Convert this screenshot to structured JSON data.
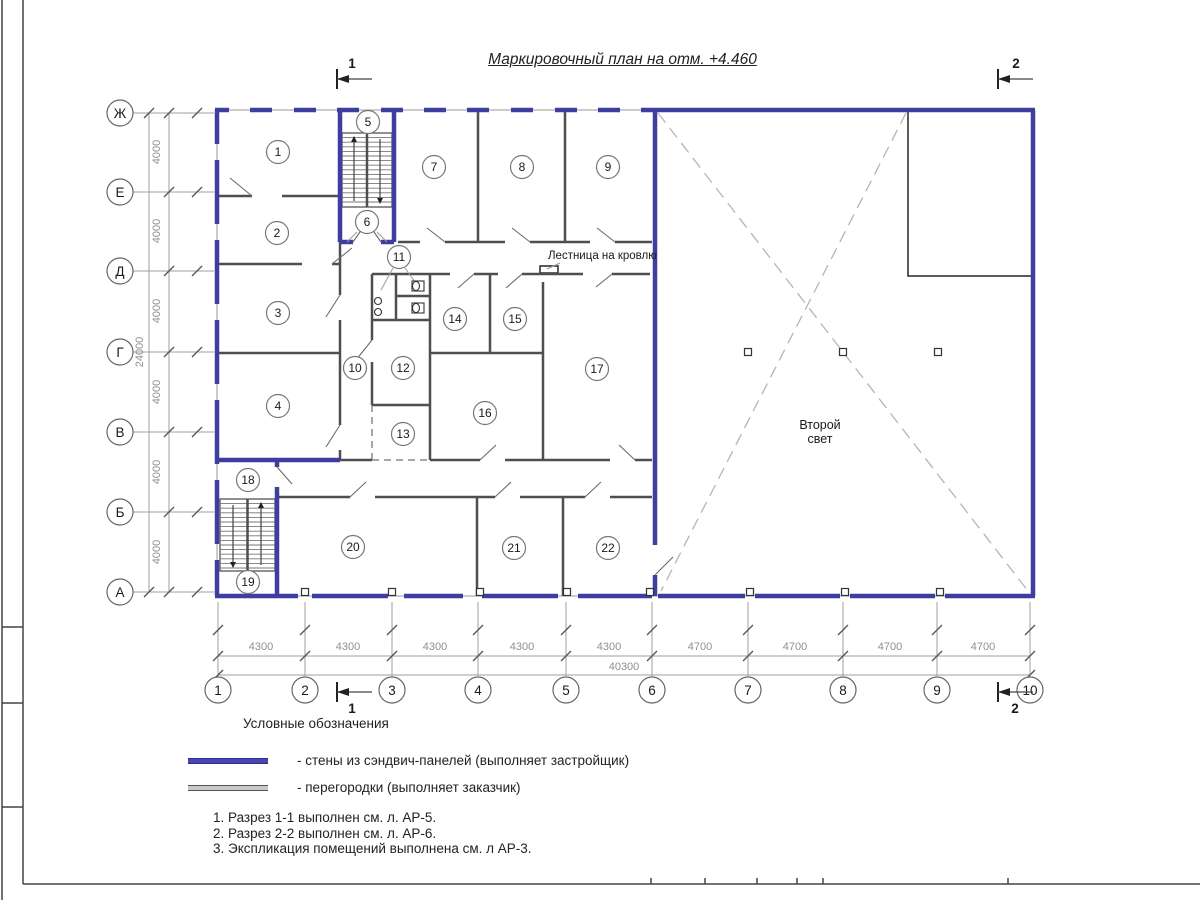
{
  "title": "Маркировочный план на отм. +4.460",
  "legend": {
    "heading": "Условные обозначения",
    "items": [
      {
        "swatch": "blue",
        "color": "#4646b4",
        "label": "- стены из сэндвич-панелей (выполняет застройщик)"
      },
      {
        "swatch": "gray",
        "color": "#c9c9c9",
        "label": "- перегородки (выполняет заказчик)"
      }
    ]
  },
  "notes": [
    "1. Разрез 1-1 выполнен см. л. АР-5.",
    "2. Разрез 2-2 выполнен см. л. АР-6.",
    "3. Экспликация помещений выполнена см. л АР-3."
  ],
  "axes": {
    "rows": [
      {
        "label": "Ж",
        "y": 113
      },
      {
        "label": "Е",
        "y": 192
      },
      {
        "label": "Д",
        "y": 271
      },
      {
        "label": "Г",
        "y": 352
      },
      {
        "label": "В",
        "y": 432
      },
      {
        "label": "Б",
        "y": 512
      },
      {
        "label": "А",
        "y": 592
      }
    ],
    "cols": [
      {
        "label": "1",
        "x": 218
      },
      {
        "label": "2",
        "x": 305
      },
      {
        "label": "3",
        "x": 392
      },
      {
        "label": "4",
        "x": 478
      },
      {
        "label": "5",
        "x": 566
      },
      {
        "label": "6",
        "x": 652
      },
      {
        "label": "7",
        "x": 748
      },
      {
        "label": "8",
        "x": 843
      },
      {
        "label": "9",
        "x": 937
      },
      {
        "label": "10",
        "x": 1030
      }
    ],
    "row_circle_x": 120,
    "col_circle_y": 690,
    "r": 13
  },
  "dims": {
    "lines": [
      [
        169,
        113,
        169,
        592
      ],
      [
        149,
        113,
        149,
        592
      ],
      [
        218,
        656,
        1030,
        656
      ],
      [
        218,
        675,
        1030,
        675
      ]
    ],
    "ext": [
      [
        133,
        113,
        214,
        113
      ],
      [
        133,
        192,
        214,
        192
      ],
      [
        133,
        271,
        214,
        271
      ],
      [
        133,
        352,
        214,
        352
      ],
      [
        133,
        432,
        214,
        432
      ],
      [
        133,
        512,
        214,
        512
      ],
      [
        133,
        592,
        214,
        592
      ],
      [
        218,
        602,
        218,
        676
      ],
      [
        305,
        602,
        305,
        676
      ],
      [
        392,
        602,
        392,
        676
      ],
      [
        478,
        602,
        478,
        676
      ],
      [
        566,
        602,
        566,
        676
      ],
      [
        652,
        602,
        652,
        676
      ],
      [
        748,
        602,
        748,
        676
      ],
      [
        843,
        602,
        843,
        676
      ],
      [
        937,
        602,
        937,
        676
      ],
      [
        1030,
        602,
        1030,
        676
      ]
    ],
    "ticks": [
      [
        169,
        113
      ],
      [
        169,
        192
      ],
      [
        169,
        271
      ],
      [
        169,
        352
      ],
      [
        169,
        432
      ],
      [
        169,
        512
      ],
      [
        169,
        592
      ],
      [
        149,
        113
      ],
      [
        149,
        592
      ],
      [
        197,
        113
      ],
      [
        197,
        192
      ],
      [
        197,
        271
      ],
      [
        197,
        352
      ],
      [
        197,
        432
      ],
      [
        197,
        512
      ],
      [
        197,
        592
      ],
      [
        218,
        630
      ],
      [
        305,
        630
      ],
      [
        392,
        630
      ],
      [
        478,
        630
      ],
      [
        566,
        630
      ],
      [
        652,
        630
      ],
      [
        748,
        630
      ],
      [
        843,
        630
      ],
      [
        937,
        630
      ],
      [
        1030,
        630
      ],
      [
        218,
        656
      ],
      [
        305,
        656
      ],
      [
        392,
        656
      ],
      [
        478,
        656
      ],
      [
        566,
        656
      ],
      [
        652,
        656
      ],
      [
        748,
        656
      ],
      [
        843,
        656
      ],
      [
        937,
        656
      ],
      [
        1030,
        656
      ],
      [
        218,
        675
      ],
      [
        1030,
        675
      ]
    ],
    "labels": [
      {
        "t": "4000",
        "x": 160,
        "y": 152,
        "r": -90
      },
      {
        "t": "4000",
        "x": 160,
        "y": 231,
        "r": -90
      },
      {
        "t": "4000",
        "x": 160,
        "y": 311,
        "r": -90
      },
      {
        "t": "4000",
        "x": 160,
        "y": 392,
        "r": -90
      },
      {
        "t": "4000",
        "x": 160,
        "y": 472,
        "r": -90
      },
      {
        "t": "4000",
        "x": 160,
        "y": 552,
        "r": -90
      },
      {
        "t": "24000",
        "x": 143,
        "y": 352,
        "r": -90
      },
      {
        "t": "4300",
        "x": 261,
        "y": 650
      },
      {
        "t": "4300",
        "x": 348,
        "y": 650
      },
      {
        "t": "4300",
        "x": 435,
        "y": 650
      },
      {
        "t": "4300",
        "x": 522,
        "y": 650
      },
      {
        "t": "4300",
        "x": 609,
        "y": 650
      },
      {
        "t": "4700",
        "x": 700,
        "y": 650
      },
      {
        "t": "4700",
        "x": 795,
        "y": 650
      },
      {
        "t": "4700",
        "x": 890,
        "y": 650
      },
      {
        "t": "4700",
        "x": 983,
        "y": 650
      },
      {
        "t": "40300",
        "x": 624,
        "y": 670
      }
    ]
  },
  "marks": [
    {
      "n": "1",
      "bx": 337,
      "y": 79,
      "x2": 372,
      "nx": 352,
      "ny": 68
    },
    {
      "n": "2",
      "bx": 998,
      "y": 79,
      "x2": 1033,
      "nx": 1016,
      "ny": 68
    },
    {
      "n": "1",
      "bx": 337,
      "y": 692,
      "x2": 372,
      "nx": 352,
      "ny": 713
    },
    {
      "n": "2",
      "bx": 998,
      "y": 692,
      "x2": 1033,
      "nx": 1015,
      "ny": 713
    }
  ],
  "plan": {
    "texts": [
      {
        "t": "Лестница на кровлю",
        "x": 548,
        "y": 259,
        "a": "start",
        "cls": "t-lbl"
      },
      {
        "t": "Второй",
        "x": 820,
        "y": 429,
        "a": "middle",
        "cls": "t-lbl2"
      },
      {
        "t": "свет",
        "x": 820,
        "y": 443,
        "a": "middle",
        "cls": "t-lbl2"
      }
    ],
    "thin": [
      [
        215,
        110,
        655,
        110
      ],
      [
        217,
        110,
        217,
        596
      ],
      [
        215,
        596,
        1035,
        596
      ]
    ],
    "blue": [
      [
        215,
        110,
        229,
        110
      ],
      [
        250,
        110,
        272,
        110
      ],
      [
        294,
        110,
        316,
        110
      ],
      [
        337,
        110,
        359,
        110
      ],
      [
        381,
        110,
        403,
        110
      ],
      [
        424,
        110,
        446,
        110
      ],
      [
        467,
        110,
        489,
        110
      ],
      [
        511,
        110,
        533,
        110
      ],
      [
        555,
        110,
        577,
        110
      ],
      [
        598,
        110,
        620,
        110
      ],
      [
        641,
        110,
        1035,
        110
      ],
      [
        1033,
        110,
        1033,
        596
      ],
      [
        215,
        596,
        298,
        596
      ],
      [
        312,
        596,
        388,
        596
      ],
      [
        404,
        596,
        463,
        596
      ],
      [
        482,
        596,
        558,
        596
      ],
      [
        578,
        596,
        652,
        596
      ],
      [
        658,
        596,
        745,
        596
      ],
      [
        755,
        596,
        840,
        596
      ],
      [
        850,
        596,
        935,
        596
      ],
      [
        945,
        596,
        1035,
        596
      ],
      [
        217,
        110,
        217,
        144
      ],
      [
        217,
        160,
        217,
        224
      ],
      [
        217,
        240,
        217,
        304
      ],
      [
        217,
        320,
        217,
        384
      ],
      [
        217,
        400,
        217,
        464
      ],
      [
        217,
        480,
        217,
        544
      ],
      [
        217,
        560,
        217,
        596
      ],
      [
        655,
        110,
        655,
        545
      ],
      [
        655,
        575,
        655,
        596
      ],
      [
        340,
        110,
        340,
        242
      ],
      [
        394,
        110,
        394,
        242
      ],
      [
        340,
        242,
        353,
        242
      ],
      [
        381,
        242,
        394,
        242
      ],
      [
        215,
        460,
        340,
        460
      ],
      [
        277,
        460,
        277,
        467
      ],
      [
        277,
        487,
        277,
        596
      ]
    ],
    "gray": [
      [
        217,
        196,
        252,
        196
      ],
      [
        282,
        196,
        340,
        196
      ],
      [
        398,
        242,
        420,
        242
      ],
      [
        445,
        242,
        505,
        242
      ],
      [
        530,
        242,
        590,
        242
      ],
      [
        615,
        242,
        652,
        242
      ],
      [
        217,
        264,
        302,
        264
      ],
      [
        332,
        264,
        340,
        264
      ],
      [
        372,
        274,
        450,
        274
      ],
      [
        474,
        274,
        498,
        274
      ],
      [
        522,
        274,
        583,
        274
      ],
      [
        612,
        274,
        650,
        274
      ],
      [
        396,
        296,
        430,
        296
      ],
      [
        372,
        320,
        430,
        320
      ],
      [
        217,
        353,
        340,
        353
      ],
      [
        430,
        353,
        543,
        353
      ],
      [
        372,
        405,
        430,
        405
      ],
      [
        340,
        460,
        372,
        460
      ],
      [
        430,
        460,
        480,
        460
      ],
      [
        505,
        460,
        610,
        460
      ],
      [
        635,
        460,
        652,
        460
      ],
      [
        277,
        497,
        350,
        497
      ],
      [
        375,
        497,
        495,
        497
      ],
      [
        520,
        497,
        585,
        497
      ],
      [
        610,
        497,
        652,
        497
      ],
      [
        340,
        242,
        340,
        295
      ],
      [
        340,
        320,
        340,
        425
      ],
      [
        340,
        450,
        340,
        460
      ],
      [
        372,
        274,
        372,
        340
      ],
      [
        372,
        362,
        372,
        405
      ],
      [
        396,
        274,
        396,
        320
      ],
      [
        430,
        274,
        430,
        460
      ],
      [
        490,
        274,
        490,
        353
      ],
      [
        543,
        282,
        543,
        460
      ],
      [
        478,
        110,
        478,
        242
      ],
      [
        565,
        110,
        565,
        242
      ],
      [
        477,
        497,
        477,
        596
      ],
      [
        563,
        497,
        563,
        596
      ]
    ],
    "leaf": [
      [
        252,
        196,
        230,
        178
      ],
      [
        332,
        264,
        352,
        248
      ],
      [
        445,
        242,
        427,
        228
      ],
      [
        530,
        242,
        512,
        228
      ],
      [
        615,
        242,
        597,
        228
      ],
      [
        340,
        295,
        326,
        317
      ],
      [
        340,
        425,
        326,
        447
      ],
      [
        372,
        340,
        356,
        360
      ],
      [
        474,
        274,
        458,
        288
      ],
      [
        522,
        274,
        506,
        288
      ],
      [
        612,
        274,
        596,
        287
      ],
      [
        480,
        460,
        496,
        445
      ],
      [
        635,
        460,
        619,
        445
      ],
      [
        350,
        497,
        366,
        482
      ],
      [
        495,
        497,
        511,
        482
      ],
      [
        585,
        497,
        601,
        482
      ],
      [
        353,
        242,
        362,
        229
      ],
      [
        381,
        242,
        372,
        229
      ],
      [
        655,
        575,
        673,
        557
      ],
      [
        277,
        467,
        292,
        484
      ]
    ],
    "leaders": [
      [
        357,
        232,
        347,
        242
      ],
      [
        377,
        232,
        387,
        242
      ],
      [
        393,
        268,
        381,
        290
      ],
      [
        405,
        268,
        415,
        282
      ],
      [
        560,
        263,
        547,
        269
      ]
    ],
    "dashed_light": [
      [
        658,
        113,
        1028,
        591
      ],
      [
        906,
        113,
        661,
        591
      ]
    ],
    "dashed_dark": [
      [
        372,
        405,
        372,
        460
      ],
      [
        372,
        460,
        430,
        460
      ]
    ],
    "cutout": {
      "x": 908,
      "y": 110,
      "w": 124,
      "h": 166
    },
    "hatch": {
      "x": 540,
      "y": 266,
      "w": 18,
      "h": 7
    },
    "squares": [
      [
        748,
        352
      ],
      [
        843,
        352
      ],
      [
        938,
        352
      ],
      [
        305,
        592
      ],
      [
        392,
        592
      ],
      [
        480,
        592
      ],
      [
        567,
        592
      ],
      [
        650,
        592
      ],
      [
        750,
        592
      ],
      [
        845,
        592
      ],
      [
        940,
        592
      ]
    ],
    "stairs": [
      {
        "x": 342,
        "y": 133,
        "w": 50,
        "h": 74,
        "upX": 354,
        "downX": 380
      },
      {
        "x": 220,
        "y": 499,
        "w": 55,
        "h": 72,
        "upX": 261,
        "downX": 233
      }
    ],
    "toilets": [
      {
        "x": 412,
        "y": 281
      },
      {
        "x": 412,
        "y": 303
      }
    ],
    "sinks": [
      [
        378,
        301
      ],
      [
        378,
        312
      ]
    ],
    "room_circles": [
      {
        "n": "1",
        "x": 278,
        "y": 152
      },
      {
        "n": "2",
        "x": 277,
        "y": 233
      },
      {
        "n": "3",
        "x": 278,
        "y": 313
      },
      {
        "n": "4",
        "x": 278,
        "y": 406
      },
      {
        "n": "5",
        "x": 368,
        "y": 122
      },
      {
        "n": "6",
        "x": 367,
        "y": 222
      },
      {
        "n": "7",
        "x": 434,
        "y": 167
      },
      {
        "n": "8",
        "x": 522,
        "y": 167
      },
      {
        "n": "9",
        "x": 608,
        "y": 167
      },
      {
        "n": "10",
        "x": 355,
        "y": 368
      },
      {
        "n": "11",
        "x": 399,
        "y": 257
      },
      {
        "n": "12",
        "x": 403,
        "y": 368
      },
      {
        "n": "13",
        "x": 403,
        "y": 434
      },
      {
        "n": "14",
        "x": 455,
        "y": 319
      },
      {
        "n": "15",
        "x": 515,
        "y": 319
      },
      {
        "n": "16",
        "x": 485,
        "y": 413
      },
      {
        "n": "17",
        "x": 597,
        "y": 369
      },
      {
        "n": "18",
        "x": 248,
        "y": 480
      },
      {
        "n": "19",
        "x": 248,
        "y": 582
      },
      {
        "n": "20",
        "x": 353,
        "y": 547
      },
      {
        "n": "21",
        "x": 514,
        "y": 548
      },
      {
        "n": "22",
        "x": 608,
        "y": 548
      }
    ]
  },
  "frame": {
    "lines": [
      [
        2,
        0,
        2,
        900
      ],
      [
        23,
        0,
        23,
        884
      ],
      [
        2,
        627,
        23,
        627
      ],
      [
        2,
        703,
        23,
        703
      ],
      [
        2,
        807,
        23,
        807
      ],
      [
        23,
        884,
        1200,
        884
      ]
    ],
    "ticks": [
      651,
      705,
      757,
      797,
      823,
      1008
    ]
  }
}
